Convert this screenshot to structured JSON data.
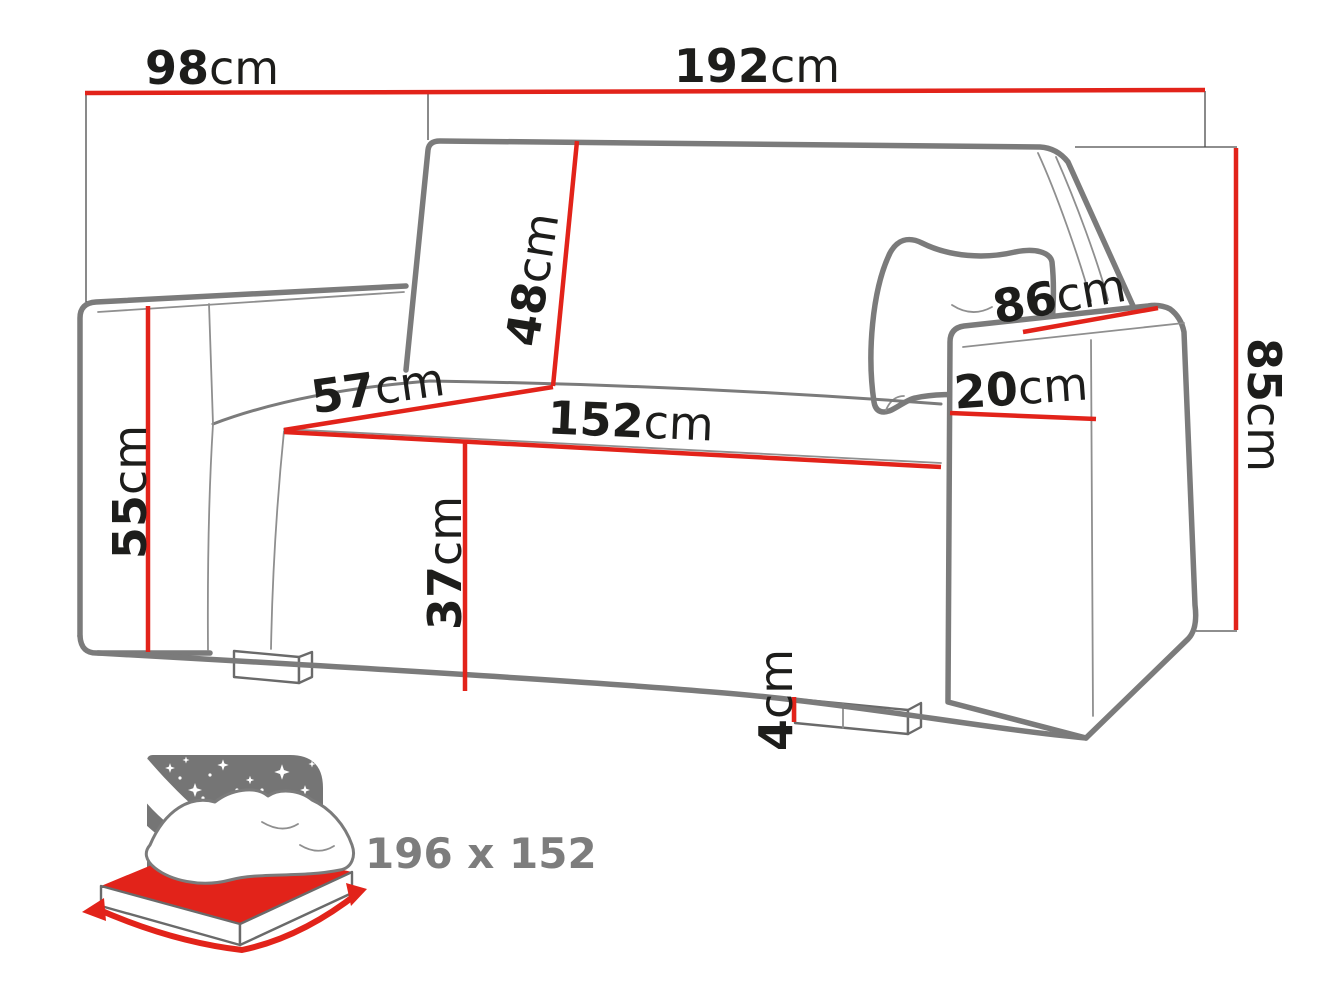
{
  "palette": {
    "red": "#e2231a",
    "outline_gray": "#7b7b7b",
    "thin_gray": "#8f8f8f",
    "extension_gray": "#4a4a4a",
    "text_black": "#1d1d1b",
    "icon_gray": "#757575",
    "caption_gray": "#7d7d7d",
    "background": "#ffffff"
  },
  "dims": {
    "depth": {
      "value": "98",
      "unit": "cm"
    },
    "width": {
      "value": "192",
      "unit": "cm"
    },
    "backrest_height": {
      "value": "48",
      "unit": "cm"
    },
    "seat_depth": {
      "value": "57",
      "unit": "cm"
    },
    "seat_width": {
      "value": "152",
      "unit": "cm"
    },
    "armrest_height": {
      "value": "55",
      "unit": "cm"
    },
    "seat_height": {
      "value": "37",
      "unit": "cm"
    },
    "leg_height": {
      "value": "4",
      "unit": "cm"
    },
    "armrest_length": {
      "value": "86",
      "unit": "cm"
    },
    "armrest_width": {
      "value": "20",
      "unit": "cm"
    },
    "height": {
      "value": "85",
      "unit": "cm"
    }
  },
  "sleeping_area": {
    "label": "196 x 152"
  }
}
